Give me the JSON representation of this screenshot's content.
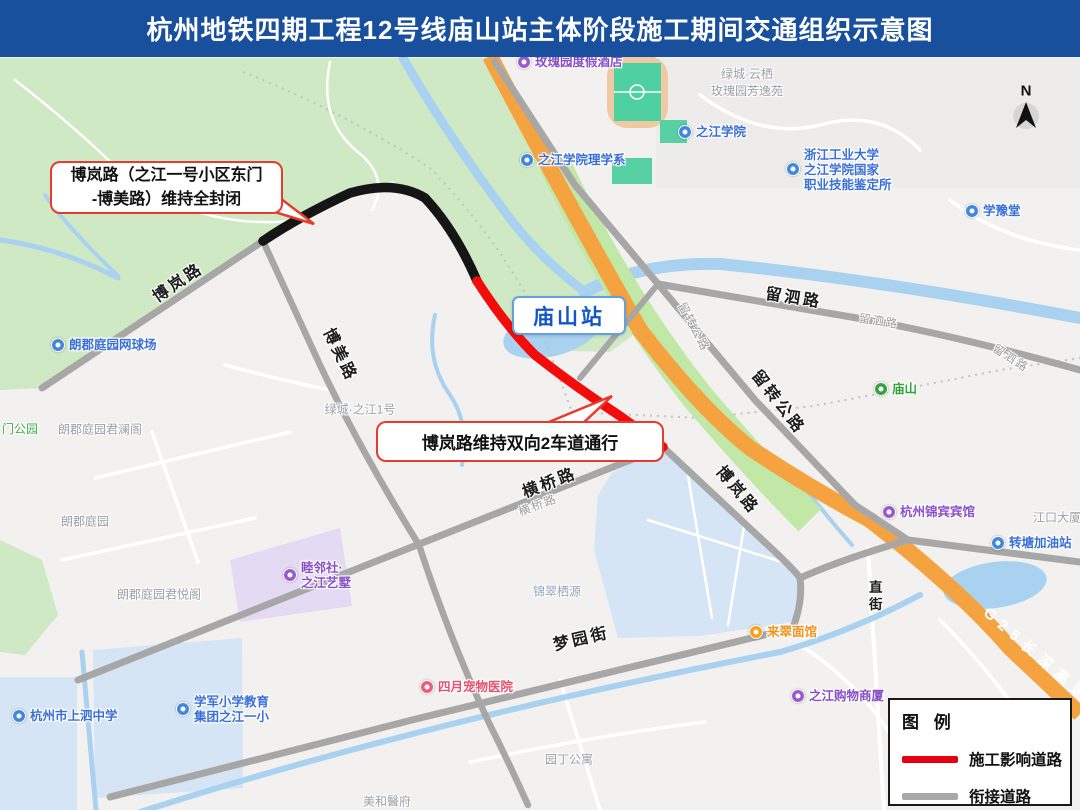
{
  "banner": {
    "title": "杭州地铁四期工程12号线庙山站主体阶段施工期间交通组织示意图"
  },
  "station": {
    "label": "庙山站"
  },
  "callouts": {
    "closure_line1": "博岚路（之江一号小区东门",
    "closure_line2": "-博美路）维持全封闭",
    "lanes": "博岚路维持双向2车道通行"
  },
  "legend": {
    "title": "图 例",
    "item_construction": "施工影响道路",
    "item_connecting": "衔接道路"
  },
  "compass": {
    "label": "N"
  },
  "roads": {
    "bolan": "博岚路",
    "bomei": "博美路",
    "hengqiao": "横桥路",
    "mengyuan": "梦园街",
    "liusi": "留泗路",
    "liuzhuan": "留转公路",
    "zhijie_l1": "直",
    "zhijie_l2": "街",
    "g25": "G25长深高速"
  },
  "pois": {
    "rose_hotel": "玫瑰园度假酒店",
    "zhijiang_college": "之江学院",
    "science_dept": "之江学院理学系",
    "skill_line1": "浙江工业大学",
    "skill_line2": "之江学院国家",
    "skill_line3": "职业技能鉴定所",
    "xueyutang": "学豫堂",
    "miaoshan": "庙山",
    "jinbin_hotel": "杭州锦宾宾馆",
    "gas_station": "转塘加油站",
    "laicui": "来翠面馆",
    "shopping": "之江购物商厦",
    "pet_hospital": "四月宠物医院",
    "tennis": "朗郡庭园网球场",
    "shangsi": "杭州市上泗中学",
    "xuejun_line1": "学军小学教育",
    "xuejun_line2": "集团之江一小",
    "mulin_line1": "睦邻社·",
    "mulin_line2": "之江艺墅"
  },
  "areas": {
    "rose_garden_line1": "绿城·云栖",
    "rose_garden_line2": "玫瑰园芳逸苑",
    "langjun": "朗郡庭园",
    "langjun_junlan": "朗郡庭园君澜阁",
    "langjun_junyue": "朗郡庭园君悦阁",
    "gate_park": "门公园",
    "lvcheng1": "绿城·之江1号",
    "jincui": "锦翠栖源",
    "yuanding": "园丁公寓",
    "meihe": "美和醫府",
    "jiangkou": "江口大厦"
  },
  "colors": {
    "banner": "#19509E",
    "closed_road": "#151515",
    "construction_road": "#F30C0C",
    "connecting_road": "#A7A7A7",
    "highway": "#F4A340",
    "water": "#A8D2F0",
    "park": "#CFE9C4",
    "station_text": "#1356C8",
    "legend_red": "#E60012",
    "legend_gray": "#A8A8A8"
  }
}
